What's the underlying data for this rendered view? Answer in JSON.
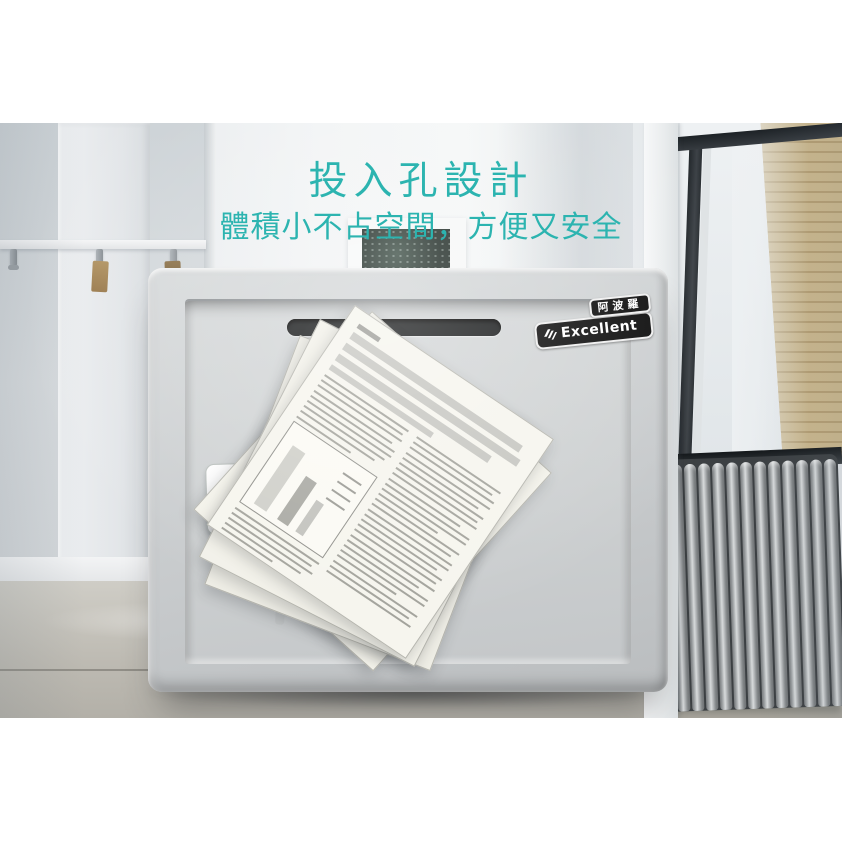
{
  "overlay": {
    "title": "投入孔設計",
    "subtitle": "體積小不占空間，方便又安全",
    "text_color": "#2cb4b0"
  },
  "safe": {
    "badge": {
      "brand_cn": "阿波羅",
      "brand_en": "Excellent",
      "logo_icon": "excellent-logo",
      "bg_color": "#0d0d0d",
      "text_color": "#ffffff"
    },
    "keyplate": {
      "brand": "Excellent",
      "brand_color": "#282c97",
      "logo_icon": "excellent-logo"
    },
    "body_color": "#c9cccd",
    "door_color": "#d0d3d4",
    "slot_color": "#17191a"
  },
  "scene": {
    "accent_teal": "#2cb4b0",
    "wall_color": "#e7eaec",
    "floor_color": "#bdbab2",
    "brick_color": "#c4ae82",
    "radiator_color": "#9ea2a4"
  }
}
